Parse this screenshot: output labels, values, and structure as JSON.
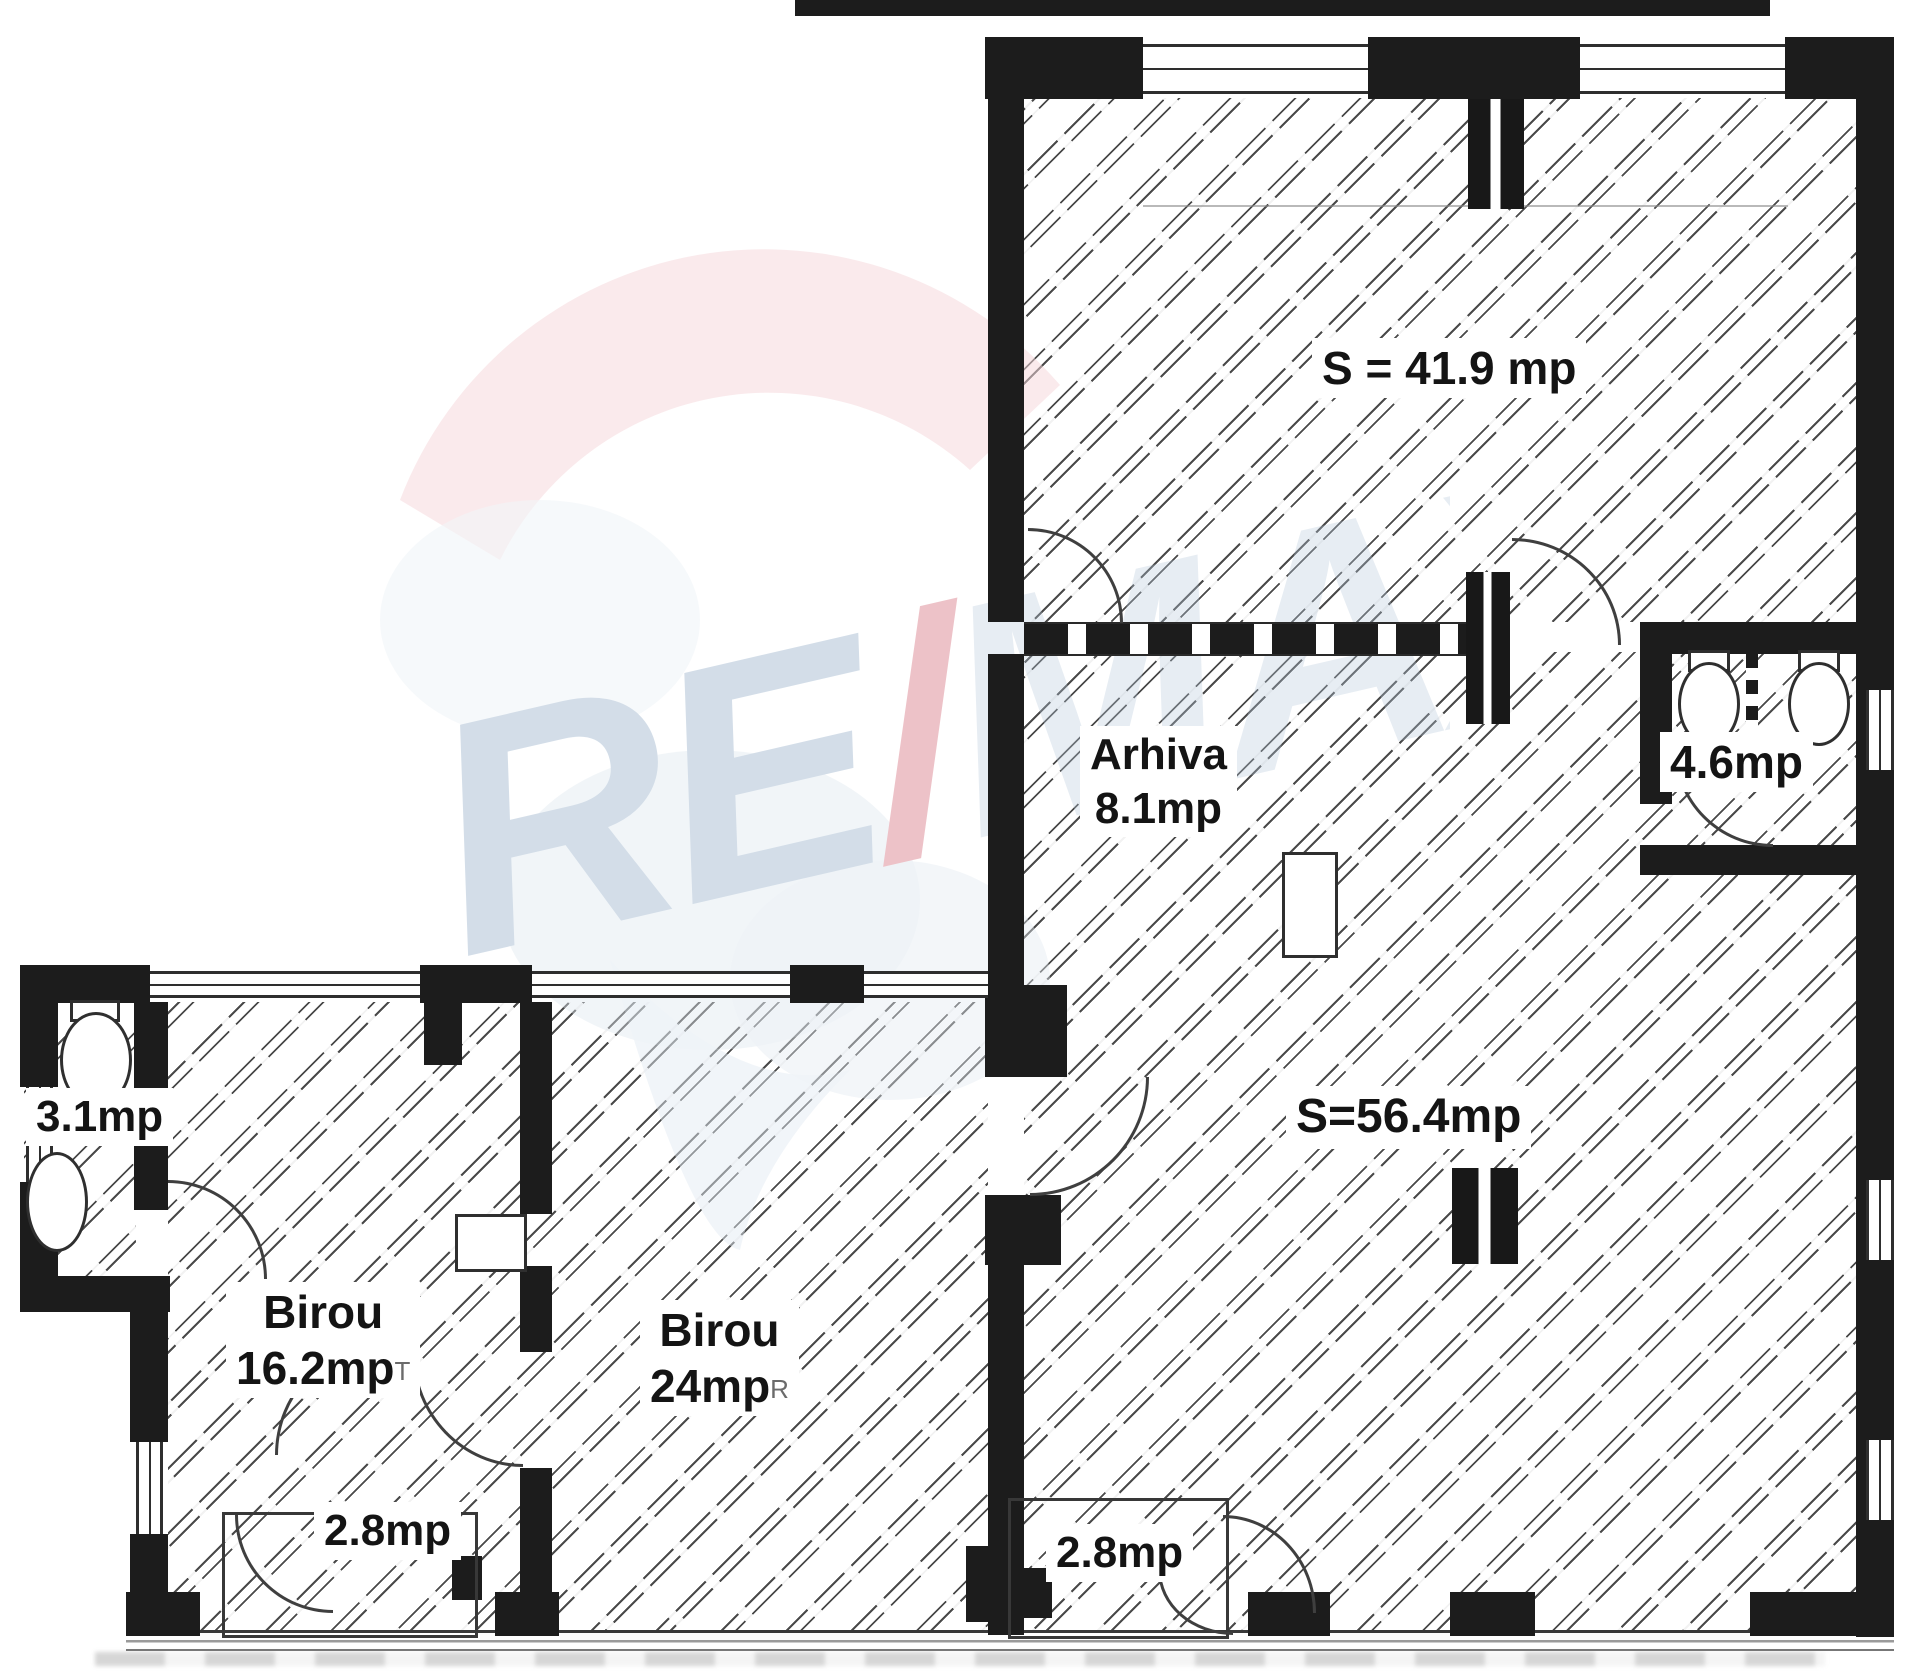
{
  "watermark": {
    "re": "RE",
    "slash": "/",
    "max": "MAX"
  },
  "rooms": {
    "hall_top": {
      "label": "S = 41.9 mp"
    },
    "arhiva": {
      "name": "Arhiva",
      "area": "8.1mp"
    },
    "wc_top_right": {
      "area": "4.6mp"
    },
    "hall_main": {
      "label": "S=56.4mp"
    },
    "wc_left": {
      "area": "3.1mp"
    },
    "birou_small": {
      "name": "Birou",
      "area": "16.2mp",
      "scan_mark": "T"
    },
    "birou_large": {
      "name": "Birou",
      "area": "24mp",
      "scan_mark": "R"
    },
    "vestibule_left": {
      "area": "2.8mp"
    },
    "vestibule_right": {
      "area": "2.8mp"
    }
  },
  "colors": {
    "wall": "#1c1c1c",
    "hatch_line": "#4a4a4a",
    "label_text": "#141414",
    "watermark_blue": "#b6c8da",
    "watermark_pink": "#e29aa4",
    "watermark_cap": "#f6d7db"
  }
}
